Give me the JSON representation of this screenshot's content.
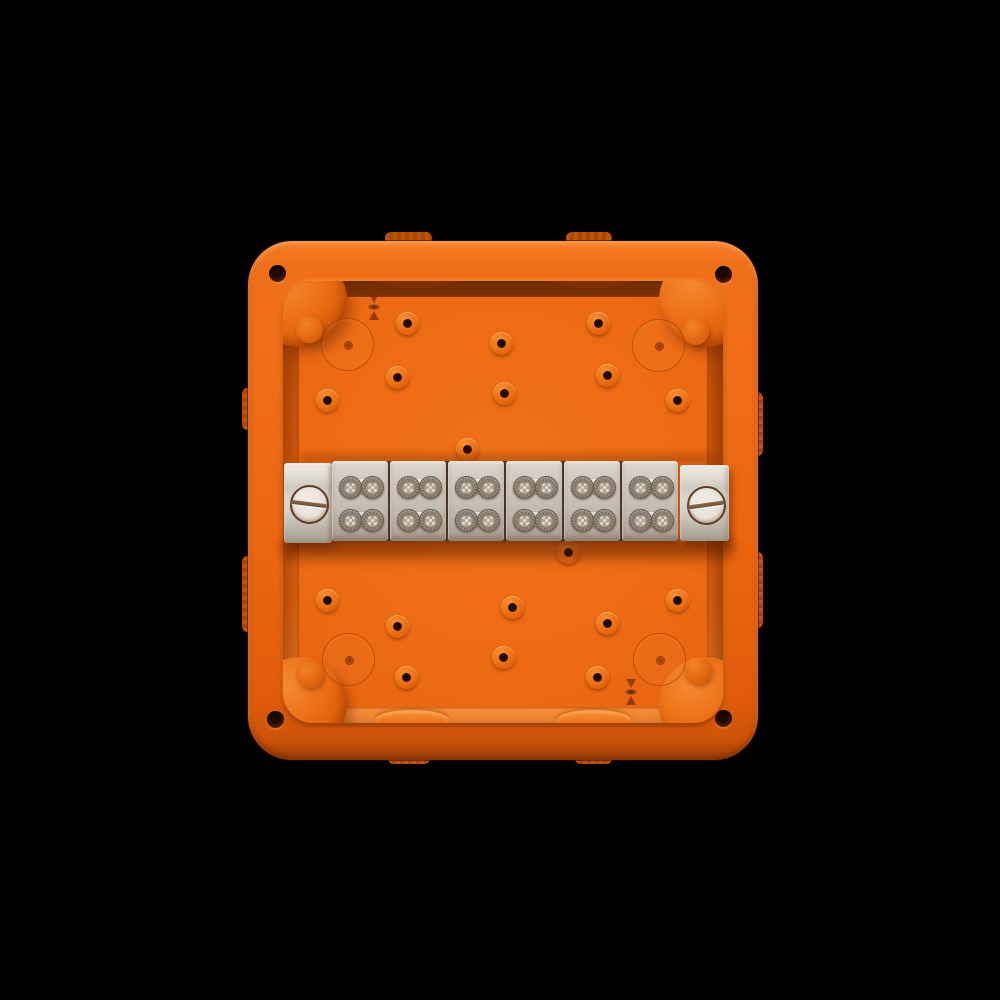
{
  "scene": {
    "type": "product-photo",
    "subject": "Orange fire-protection electrical junction box, open, viewed from above, with a six-pole terminal block strip mounted on a rail across the middle",
    "background_color": "#000000",
    "box_color": "#ec6a12",
    "wall_shadow_color": "#9c4106",
    "terminal_block_color": "#c9c0b5",
    "clamp_screw_color": "#8a7f70",
    "end_screw_color": "#e9e4db",
    "counts": {
      "terminal_blocks": 6,
      "clamp_screws_per_block": 4,
      "end_bracket_screws": 2,
      "lid_screw_holes": 4,
      "knockout_circles": 4,
      "floor_bosses": 18,
      "mold_marks": 2
    },
    "features": {
      "bosses": [
        [
          407,
          323
        ],
        [
          501,
          343
        ],
        [
          598,
          323
        ],
        [
          397,
          377
        ],
        [
          607,
          375
        ],
        [
          327,
          400
        ],
        [
          504,
          393
        ],
        [
          677,
          400
        ],
        [
          467,
          449
        ],
        [
          568,
          552
        ],
        [
          327,
          600
        ],
        [
          512,
          607
        ],
        [
          677,
          600
        ],
        [
          397,
          626
        ],
        [
          607,
          623
        ],
        [
          406,
          677
        ],
        [
          503,
          657
        ],
        [
          597,
          677
        ]
      ],
      "knockouts": [
        [
          346,
          343
        ],
        [
          657,
          344
        ],
        [
          347,
          658
        ],
        [
          658,
          658
        ]
      ],
      "corner_holes": [
        [
          277,
          273
        ],
        [
          723,
          274
        ],
        [
          275,
          719
        ],
        [
          723,
          718
        ]
      ],
      "towers": [
        [
          300,
          300
        ],
        [
          706,
          300
        ],
        [
          300,
          704
        ],
        [
          706,
          704
        ]
      ],
      "tower_bumps": [
        [
          309,
          329
        ],
        [
          695,
          331
        ],
        [
          309,
          674
        ],
        [
          697,
          670
        ]
      ],
      "mold_marks": [
        [
          374,
          307
        ],
        [
          631,
          692
        ]
      ],
      "wall_ovals_top": [
        [
          415,
          279
        ],
        [
          592,
          279
        ]
      ],
      "wall_ovals_bottom": [
        [
          412,
          720
        ],
        [
          594,
          720
        ]
      ],
      "edge_bumps_h": [
        [
          385,
          232,
          47,
          12
        ],
        [
          566,
          232,
          46,
          12
        ],
        [
          388,
          753,
          42,
          11
        ],
        [
          575,
          753,
          37,
          11
        ]
      ],
      "edge_bumps_v": [
        [
          242,
          388,
          11,
          42
        ],
        [
          242,
          556,
          11,
          76
        ],
        [
          752,
          392,
          11,
          64
        ],
        [
          752,
          552,
          11,
          76
        ]
      ],
      "blocks_left": 332,
      "blocks_top": 461,
      "block_width": 56,
      "block_gap": 2,
      "row_offsets": [
        14.5,
        47.5
      ],
      "screw_offsets": [
        6.5,
        28.5
      ]
    }
  }
}
